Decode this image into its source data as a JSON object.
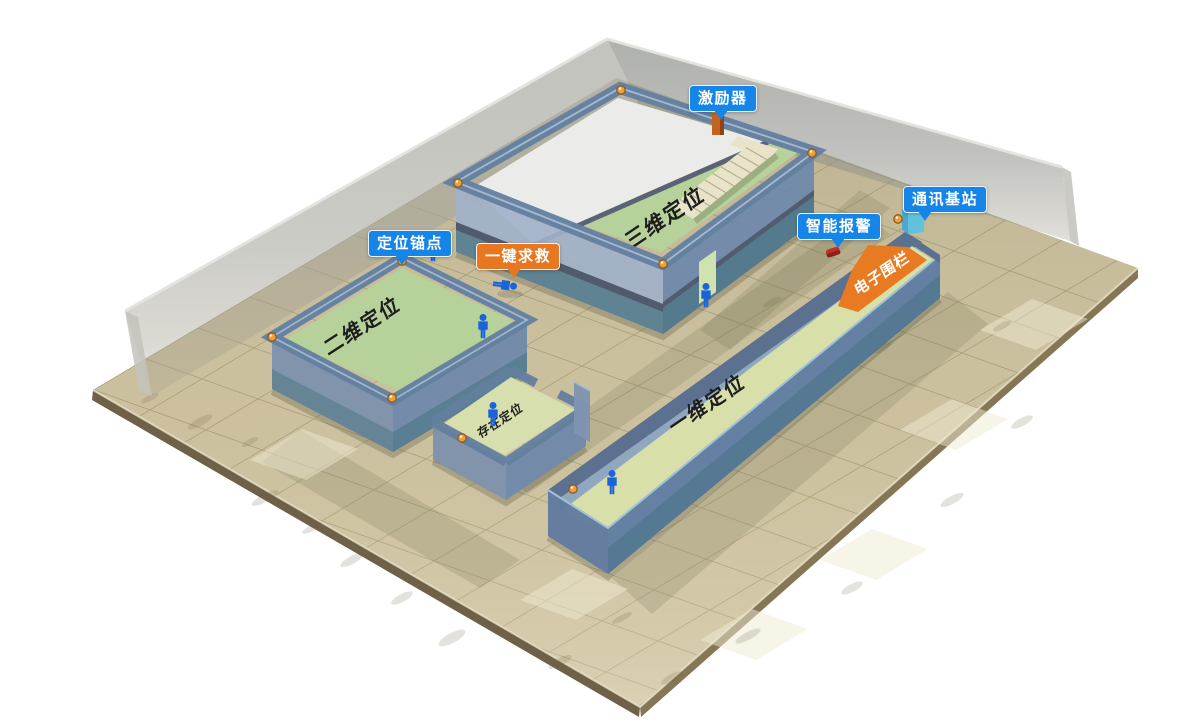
{
  "badges": {
    "exciter": {
      "label": "激励器",
      "color": "#1585e8"
    },
    "comm_station": {
      "label": "通讯基站",
      "color": "#1585e8"
    },
    "smart_alarm": {
      "label": "智能报警",
      "color": "#1585e8"
    },
    "anchor_point": {
      "label": "定位锚点",
      "color": "#1585e8"
    },
    "sos": {
      "label": "一键求救",
      "color": "#e87722"
    }
  },
  "zones": {
    "three_d": {
      "label": "三维定位"
    },
    "two_d": {
      "label": "二维定位"
    },
    "presence": {
      "label": "存在定位"
    },
    "one_d": {
      "label": "一维定位"
    },
    "fence": {
      "label": "电子围栏",
      "color": "#e87a22"
    }
  },
  "icons": {
    "anchor_dot": "positioning-anchor",
    "person": "person-tag",
    "fallen_person": "fallen-person-sos"
  },
  "colors": {
    "floor_tile": "#cbc09e",
    "wall_blue": "#6d88ab",
    "room_floor_green": "#b6d29a",
    "corridor_floor": "#d8dfa9",
    "glass_wall": "#a3a39c",
    "fence_orange": "#e87a22",
    "person_blue": "#1b63d9"
  }
}
